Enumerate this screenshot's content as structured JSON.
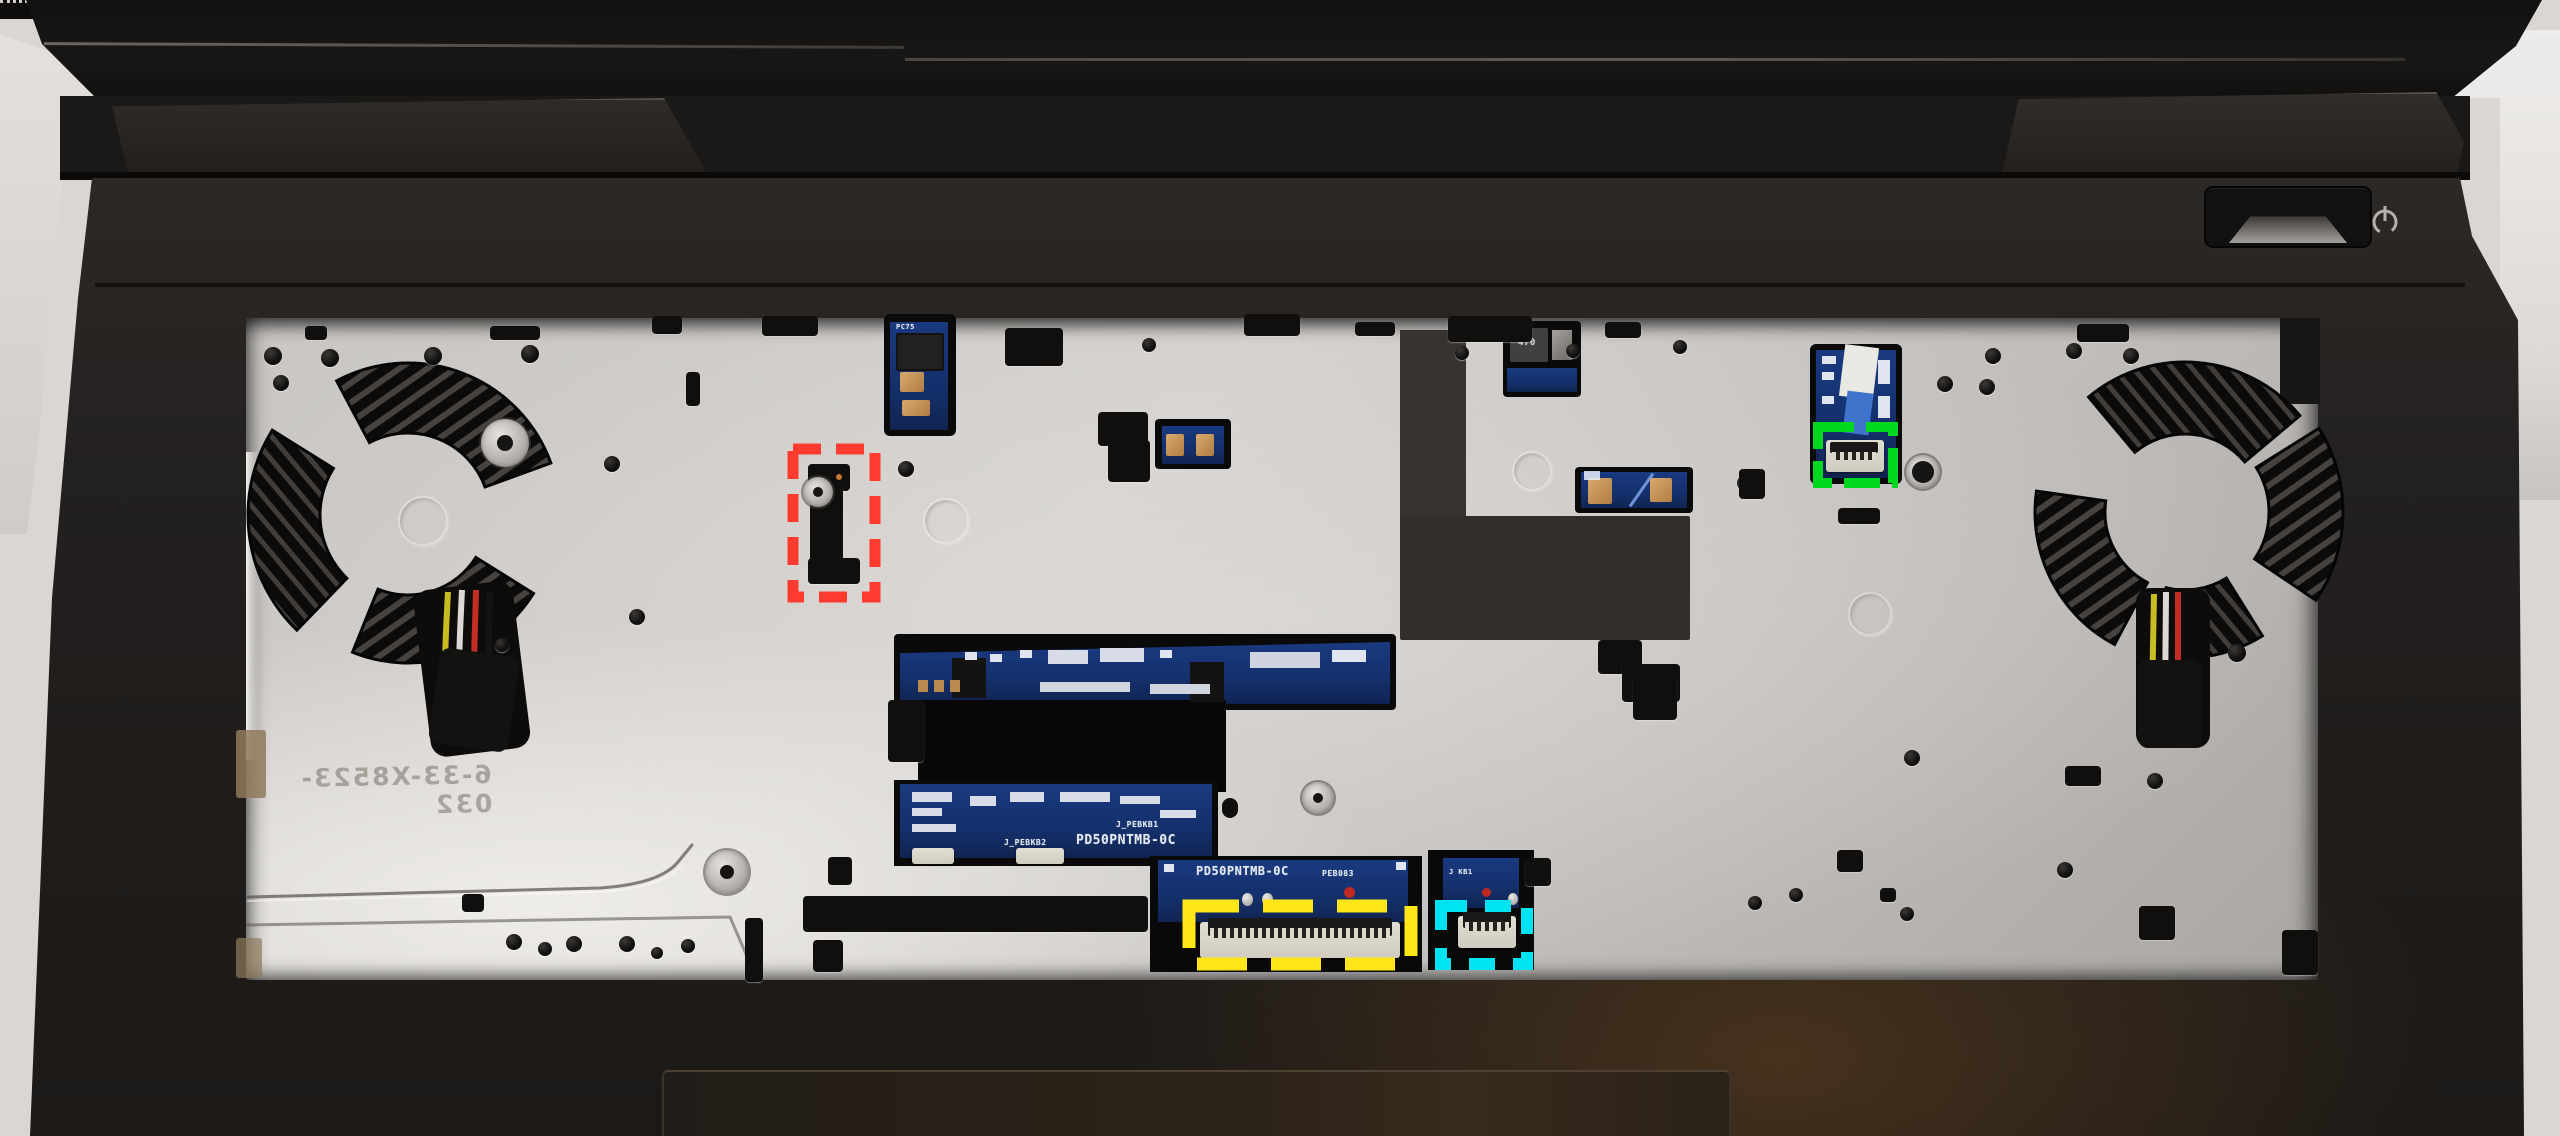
{
  "scene": {
    "subject": "Laptop upper assembly with keyboard removed exposing metal keyboard tray, cooling fans and flex-cable connectors",
    "chassis_color": "#262321",
    "tray_color": "#c9c6c3",
    "pcb_color": "#15317a"
  },
  "power": {
    "symbol_name": "power-icon"
  },
  "silkscreen": {
    "motherboard_model": "PD50PNTMB-0C",
    "rev_label": "PEB083",
    "kb_header_label": "J KB1",
    "pebkb1_label": "J_PEBKB1",
    "pebkb2_label": "J_PEBKB2",
    "inductor_value": "470",
    "pc75_label": "PC75"
  },
  "stamp": {
    "text": "6-33-X8523-032",
    "mirrored": true
  },
  "annotations": {
    "red": {
      "color": "#FF3B30",
      "style": "dashed",
      "target": "keyboard-cable-slot"
    },
    "yellow": {
      "color": "#FFE619",
      "style": "dashed",
      "target": "keyboard-ribbon-connector"
    },
    "cyan": {
      "color": "#00E4F2",
      "style": "dashed",
      "target": "small-ribbon-connector-J-KB1"
    },
    "green": {
      "color": "#00D81F",
      "style": "dashed",
      "target": "touchpad-ribbon-connector"
    }
  }
}
